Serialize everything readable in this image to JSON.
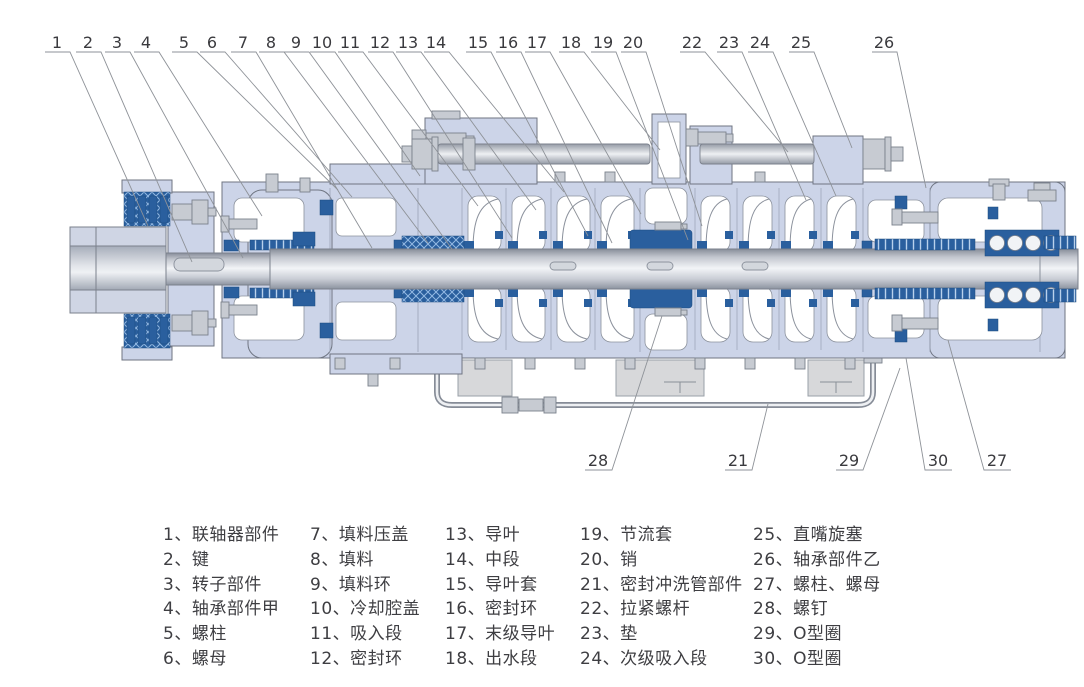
{
  "figure": {
    "kind": "multistage-pump-cross-section",
    "background": "#ffffff"
  },
  "colors": {
    "casing_fill": "#ccd4e8",
    "casing_outline": "#6f7582",
    "seal_blue": "#2a5f9e",
    "hatch_line": "#93b9e3",
    "metal_fill": "#c7cbd2",
    "metal_outline": "#7b818c",
    "foot_fill": "#d7d8da",
    "leader_line": "#8e9298",
    "text": "#3e3e42"
  },
  "callouts": {
    "top": [
      {
        "n": "1",
        "x": 57,
        "tx": 148,
        "ty": 226
      },
      {
        "n": "2",
        "x": 88,
        "tx": 192,
        "ty": 262
      },
      {
        "n": "3",
        "x": 117,
        "tx": 243,
        "ty": 258
      },
      {
        "n": "4",
        "x": 146,
        "tx": 262,
        "ty": 216
      },
      {
        "n": "5",
        "x": 184,
        "tx": 338,
        "ty": 190
      },
      {
        "n": "6",
        "x": 212,
        "tx": 352,
        "ty": 197
      },
      {
        "n": "7",
        "x": 243,
        "tx": 372,
        "ty": 248
      },
      {
        "n": "8",
        "x": 271,
        "tx": 428,
        "ty": 243
      },
      {
        "n": "9",
        "x": 296,
        "tx": 452,
        "ty": 249
      },
      {
        "n": "10",
        "x": 322,
        "tx": 420,
        "ty": 176
      },
      {
        "n": "11",
        "x": 350,
        "tx": 478,
        "ty": 206
      },
      {
        "n": "12",
        "x": 380,
        "tx": 512,
        "ty": 238
      },
      {
        "n": "13",
        "x": 408,
        "tx": 536,
        "ty": 210
      },
      {
        "n": "14",
        "x": 436,
        "tx": 564,
        "ty": 192
      },
      {
        "n": "15",
        "x": 478,
        "tx": 588,
        "ty": 236
      },
      {
        "n": "16",
        "x": 508,
        "tx": 612,
        "ty": 243
      },
      {
        "n": "17",
        "x": 537,
        "tx": 641,
        "ty": 214
      },
      {
        "n": "18",
        "x": 571,
        "tx": 660,
        "ty": 150
      },
      {
        "n": "19",
        "x": 603,
        "tx": 688,
        "ty": 240
      },
      {
        "n": "20",
        "x": 633,
        "tx": 702,
        "ty": 226
      },
      {
        "n": "22",
        "x": 692,
        "tx": 788,
        "ty": 152
      },
      {
        "n": "23",
        "x": 729,
        "tx": 806,
        "ty": 200
      },
      {
        "n": "24",
        "x": 760,
        "tx": 836,
        "ty": 196
      },
      {
        "n": "25",
        "x": 801,
        "tx": 852,
        "ty": 148
      },
      {
        "n": "26",
        "x": 884,
        "tx": 926,
        "ty": 188
      }
    ],
    "bottom": [
      {
        "n": "28",
        "x": 598,
        "side": "right",
        "tx": 662,
        "ty": 316
      },
      {
        "n": "21",
        "x": 738,
        "side": "right",
        "tx": 768,
        "ty": 404
      },
      {
        "n": "29",
        "x": 849,
        "side": "right",
        "tx": 900,
        "ty": 368
      },
      {
        "n": "30",
        "x": 938,
        "side": "left",
        "tx": 906,
        "ty": 358
      },
      {
        "n": "27",
        "x": 997,
        "side": "left",
        "tx": 948,
        "ty": 340
      }
    ]
  },
  "legend": {
    "columns": [
      {
        "items": [
          "1、联轴器部件",
          "2、键",
          "3、转子部件",
          "4、轴承部件甲",
          "5、螺柱",
          "6、螺母"
        ]
      },
      {
        "items": [
          "7、填料压盖",
          "8、填料",
          "9、填料环",
          "10、冷却腔盖",
          "11、吸入段",
          "12、密封环"
        ]
      },
      {
        "items": [
          "13、导叶",
          "14、中段",
          "15、导叶套",
          "16、密封环",
          "17、末级导叶",
          "18、出水段"
        ]
      },
      {
        "items": [
          "19、节流套",
          "20、销",
          "21、密封冲洗管部件",
          "22、拉紧螺杆",
          "23、垫",
          "24、次级吸入段"
        ]
      },
      {
        "items": [
          "25、直嘴旋塞",
          "26、轴承部件乙",
          "27、螺柱、螺母",
          "28、螺钉",
          "29、O型圈",
          "30、O型圈"
        ]
      }
    ]
  }
}
